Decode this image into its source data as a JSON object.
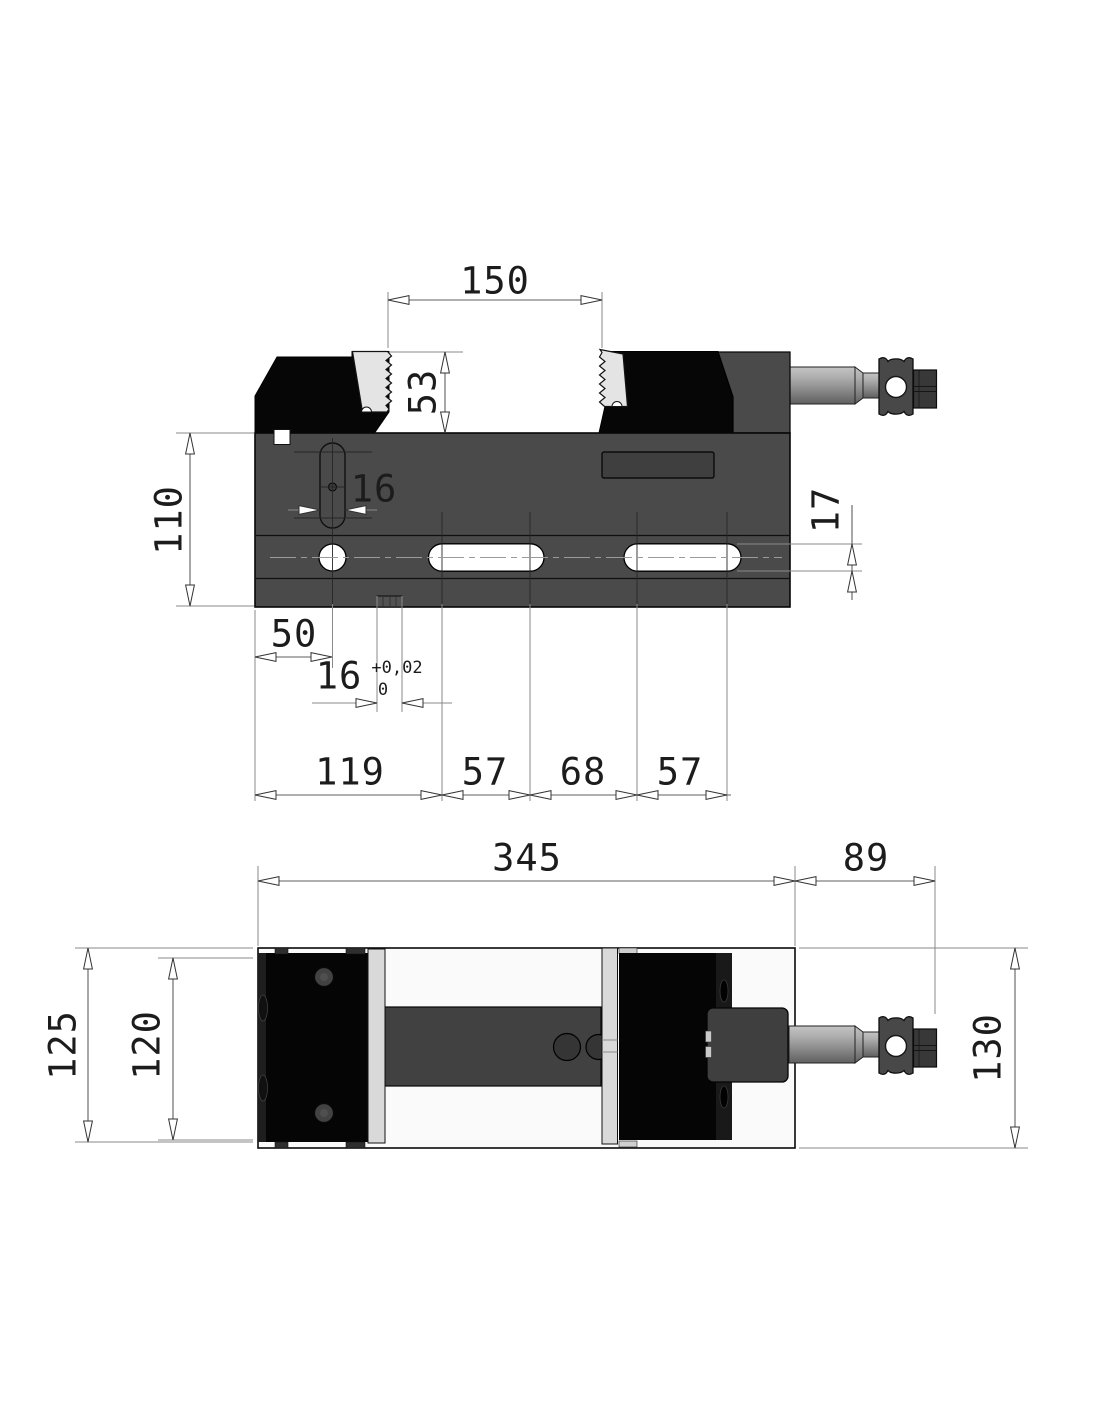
{
  "front": {
    "opening": "150",
    "jaw_height": "53",
    "body_height": "110",
    "slot_width": "16",
    "rail_height": "17",
    "hole_offset": "50",
    "key_width": "16",
    "key_tol_plus": "+0,02",
    "key_tol_minus": "0",
    "chain": [
      "119",
      "57",
      "68",
      "57"
    ]
  },
  "plan": {
    "body_length": "345",
    "spindle_length": "89",
    "base_width": "125",
    "jaw_width": "120",
    "overall_width": "130"
  },
  "colors": {
    "body": "#4a4a4a",
    "jaw": "#060606",
    "jaw_plate": "#e4e4e4",
    "channel": "#414141",
    "background": "#ffffff"
  }
}
